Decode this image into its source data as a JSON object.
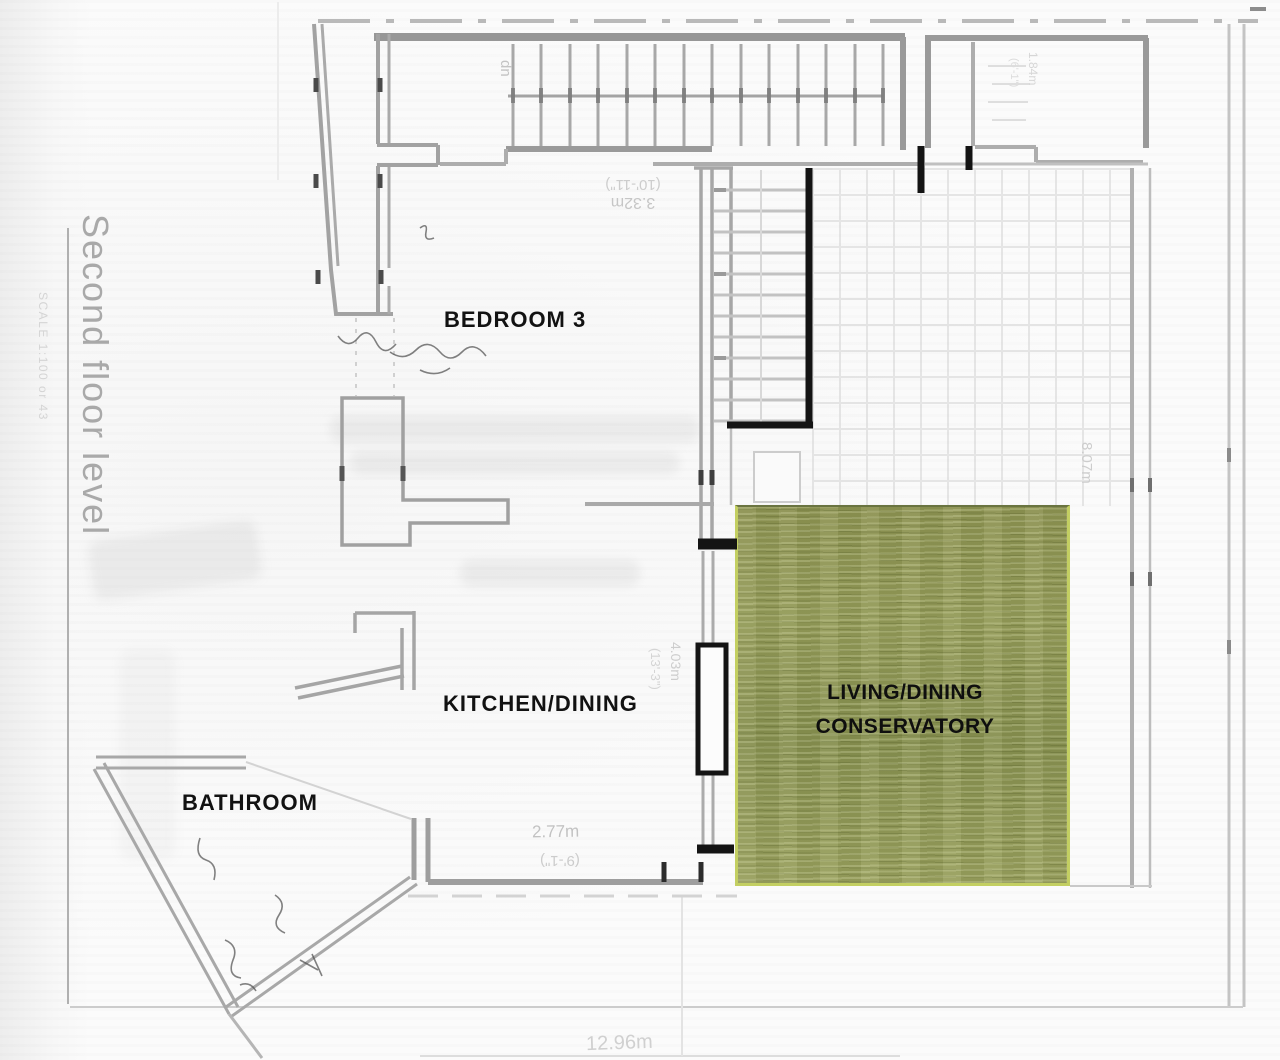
{
  "plan": {
    "title_vertical": "Second floor level",
    "scale_note": "SCALE 1:100 or 43",
    "stair_direction": "dn",
    "rooms": {
      "bedroom3": "BEDROOM 3",
      "kitchen": "KITCHEN/DINING",
      "bathroom": "BATHROOM",
      "conservatory_line1": "LIVING/DINING",
      "conservatory_line2": "CONSERVATORY"
    },
    "dimensions": {
      "stair_width_metric": "3.32m",
      "stair_width_imperial": "(10'-11\")",
      "door_height_metric": "4.03m",
      "door_height_imperial": "(13'-3\")",
      "kitchen_width_metric": "2.77m",
      "kitchen_width_imperial": "(9'-1\")",
      "conservatory_depth_metric": "8.07m",
      "store_width_metric": "1.84m",
      "store_width_imperial": "(6'-1\")",
      "overall_width_metric": "12.96m"
    },
    "colors": {
      "conservatory_green": "#8e9454",
      "conservatory_edge": "#c3cf62",
      "wall_gray": "#a0a0a0",
      "marker_black": "#141414",
      "label_black": "#121212",
      "faint_text": "#c6c6c6",
      "title_gray": "#a9a9a9"
    }
  }
}
